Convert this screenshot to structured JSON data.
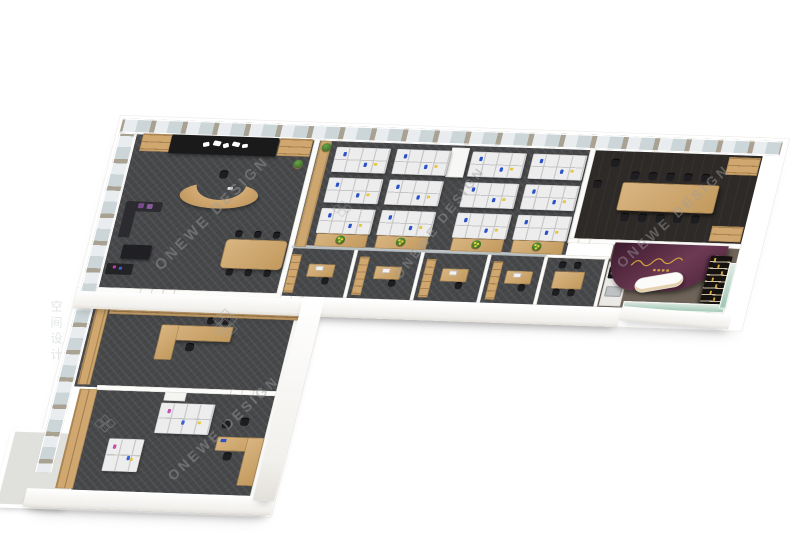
{
  "watermark": {
    "brand": "ONEWE DESIGN",
    "brand_cn": "空间设计",
    "logo": "lattice-diamond-icon",
    "color": "#9e9e9e"
  },
  "palette": {
    "background": "#ffffff",
    "carpet": "#47484a",
    "wood": "#cda76f",
    "wall": "#fcfcfb",
    "conference_floor": "#2e2a27",
    "showroom_floor": "#6e6459",
    "feature_wall_purple": "#5a2742",
    "signage_gold": "#d9a940",
    "display_wall_black": "#161210",
    "storefront_glass": "#9dc5b2",
    "workstation_white": "#ededee",
    "accent_blue": "#2b52c8",
    "accent_pink": "#c44fae",
    "plant_green": "#2f5e1d"
  },
  "layout": {
    "view": "isometric 3d floor plan, L-shaped office",
    "open_office": {
      "cluster_columns": 4,
      "cluster_rows": 3,
      "desks_per_cluster": 4,
      "sideboards_with_plants": 4
    },
    "private_offices": {
      "count": 4,
      "furniture": "desk, task chair, wood cabinet"
    },
    "conference_room": {
      "table_seats": 10,
      "corner_cabinets": 2
    },
    "reception": {
      "curved_desk": 1,
      "meeting_table_seats": 6,
      "lounge_sofa": 1,
      "logo_wall": 1
    },
    "pantry": {
      "table_seats": 4,
      "cooktop_burners": 2
    },
    "entrance_showroom": {
      "curved_counter": 1,
      "purple_feature_wall": 1,
      "display_wall_shelves": 7
    },
    "executive_office": {
      "l_desk": 1,
      "wall_shelves": 2
    },
    "workroom": {
      "clusters": 2,
      "l_desk": 1,
      "bookshelf": 1,
      "balcony": 1
    }
  }
}
